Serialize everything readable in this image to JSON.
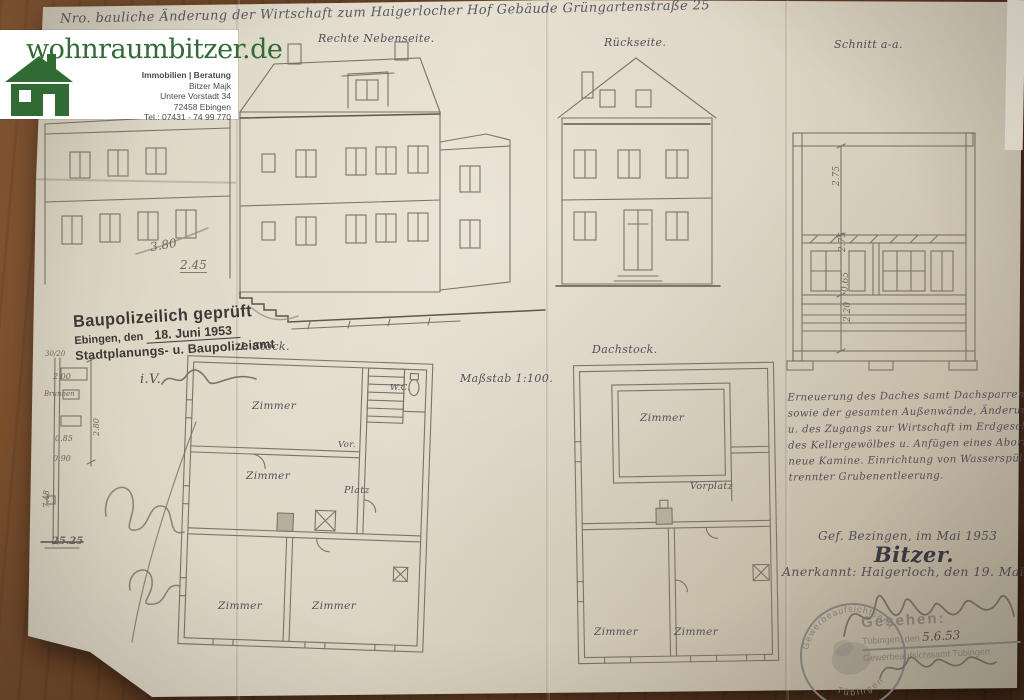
{
  "watermark": {
    "domain": "wohnraumbitzer.de",
    "tagline": "Immobilien | Beratung",
    "name": "Bitzer Majk",
    "street": "Untere Vorstadt 34",
    "city": "72458 Ebingen",
    "phone": "Tel.: 07431 - 74 99 770"
  },
  "title": "Nro. bauliche Änderung der Wirtschaft zum Haigerlocher Hof Gebäude Grüngartenstraße 25",
  "labels": {
    "street_elevation": "Rechte Nebenseite.",
    "rear_elevation": "Rückseite.",
    "section": "Schnitt a-a.",
    "scale": "Maßstab 1:100.",
    "floor1": "I. Stock.",
    "attic": "Dachstock."
  },
  "approval_stamp": {
    "line1": "Baupolizeilich geprüft",
    "city_prefix": "Ebingen, den",
    "date": "18. Juni 1953",
    "office": "Stadtplanungs- u. Baupolizeiamt",
    "iv": "i.V."
  },
  "rooms": {
    "f1_top": "Zimmer",
    "f1_mid": "Zimmer",
    "f1_vor": "Vor.",
    "f1_platz": "Platz",
    "f1_bl": "Zimmer",
    "f1_br": "Zimmer",
    "f1_wc": "W.C.",
    "a_top": "Zimmer",
    "a_hall": "Vorplatz",
    "a_bl": "Zimmer",
    "a_br": "Zimmer"
  },
  "dims": {
    "elev_a": "3.80",
    "elev_b": "2.45",
    "sec_a": "2.75",
    "sec_b": "2.75",
    "sec_c": "0.65",
    "sec_d": "2.20",
    "det_a": "30/20",
    "det_b": "2.00",
    "det_word": "Brunnen",
    "det_c": "2.80",
    "det_d": "0.85",
    "det_e": "0.90",
    "det_f": "7.48",
    "det_g": "25.25"
  },
  "notes": {
    "l1": "Erneuerung des Daches samt Dachsparren u. Kaminen",
    "l2": "sowie der gesamten Außenwände, Änderung der Fensteröffnungen",
    "l3": "u. des Zugangs zur Wirtschaft im Erdgeschoß. Neuanfertigung",
    "l4": "des Kellergewölbes u. Anfügen eines Abortstockes. Zwei",
    "l5": "neue Kamine. Einrichtung von Wasserspülung mit ge-",
    "l6": "trennter Grubenentleerung."
  },
  "signoff": {
    "made": "Gef. Bezingen, im Mai 1953",
    "signature": "Bitzer.",
    "approved": "Anerkannt: Haigerloch, den 19. Mai 1953"
  },
  "inspection": {
    "seen": "Gesehen:",
    "place_prefix": "Tübingen, den",
    "date": "5.6.53",
    "office": "Gewerbeaufsichtsamt Tübingen",
    "round_top": "Gewerbeaufsichtsamt",
    "round_bottom": "Tübingen"
  },
  "colors": {
    "wood": "#6e4426",
    "paper": "#dcd5c3",
    "brand_green": "#2f6b33",
    "ink": "#35323b",
    "pencil": "#7b7365",
    "stamp_black": "#3c3835",
    "stamp_gray": "#8b857e",
    "blue_pen": "#5353a8"
  }
}
